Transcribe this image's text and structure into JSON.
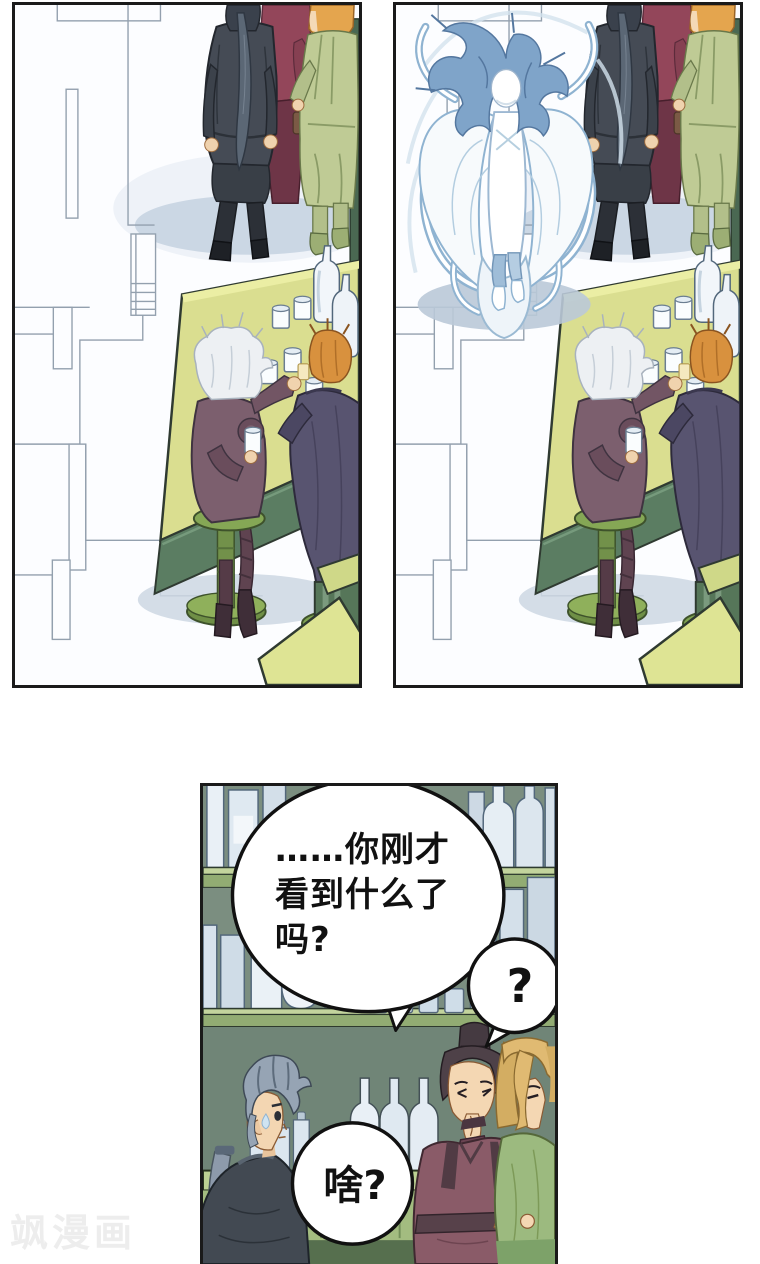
{
  "comic": {
    "speech_bubbles": {
      "question": {
        "line1": "……你刚才",
        "line2": "看到什么了",
        "line3": "吗?"
      },
      "question_mark": "?",
      "reply": "啥?"
    },
    "watermark": "飒漫画",
    "palette": {
      "panel_border": "#1a1a1a",
      "bar_table_top": "#dade90",
      "bar_table_front": "#5b7d62",
      "stool_green": "#7fa351",
      "floor_shadow_blue": "#cbd7e4",
      "ghost_blue_outline": "#8fb3d1",
      "wall_green": "#7b8e80",
      "shelf_green": "#92ac73",
      "counter_green": "#bcd193",
      "robe_maroon": "#8a5b68",
      "coat_slate_purple": "#585470",
      "outfit_mauve": "#7c5f6e",
      "robe_sage_green": "#bfcb95",
      "hair_orange": "#d8913e",
      "hair_silver_blue": "#96a4b4",
      "hair_blonde": "#e0ba72",
      "speech_text": "#111111",
      "watermark_gray": "#ededed"
    }
  }
}
